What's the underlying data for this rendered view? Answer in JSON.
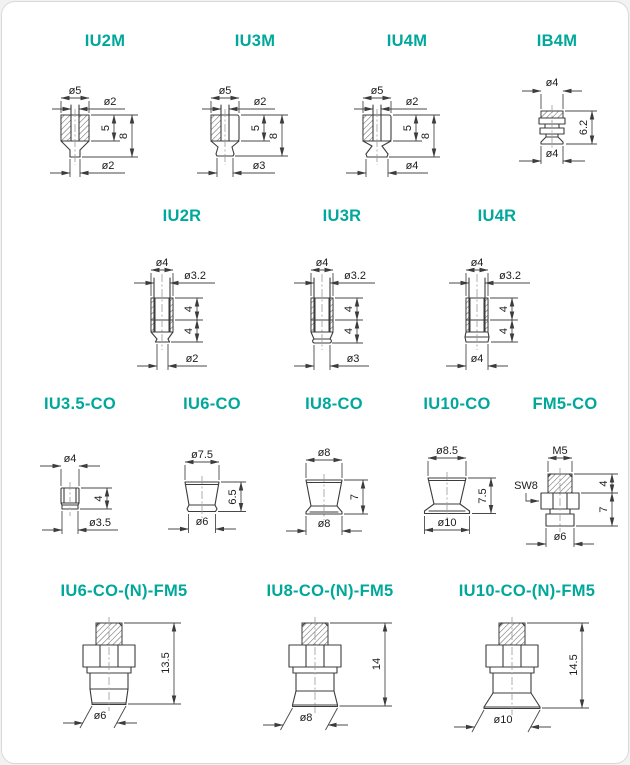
{
  "page": {
    "accent_color": "#00a89b",
    "line_color": "#3c3c3c"
  },
  "figures": {
    "iu2m": {
      "title": "IU2M",
      "top_dia": "ø5",
      "bore_dia": "ø2",
      "height_upper": "5",
      "height_total": "8",
      "bottom_dia": "ø2"
    },
    "iu3m": {
      "title": "IU3M",
      "top_dia": "ø5",
      "bore_dia": "ø2",
      "height_upper": "5",
      "height_total": "8",
      "bottom_dia": "ø3"
    },
    "iu4m": {
      "title": "IU4M",
      "top_dia": "ø5",
      "bore_dia": "ø2",
      "height_upper": "5",
      "height_total": "8",
      "bottom_dia": "ø4"
    },
    "ib4m": {
      "title": "IB4M",
      "top_dia": "ø4",
      "height": "6.2",
      "bottom_dia": "ø4"
    },
    "iu2r": {
      "title": "IU2R",
      "top_dia": "ø4",
      "bore_dia": "ø3.2",
      "height_upper": "4",
      "height_lower": "4",
      "bottom_dia": "ø2"
    },
    "iu3r": {
      "title": "IU3R",
      "top_dia": "ø4",
      "bore_dia": "ø3.2",
      "height_upper": "4",
      "height_lower": "4",
      "bottom_dia": "ø3"
    },
    "iu4r": {
      "title": "IU4R",
      "top_dia": "ø4",
      "bore_dia": "ø3.2",
      "height_upper": "4",
      "height_lower": "4",
      "bottom_dia": "ø4"
    },
    "iu35co": {
      "title": "IU3.5-CO",
      "top_dia": "ø4",
      "height": "4",
      "bottom_dia": "ø3.5"
    },
    "iu6co": {
      "title": "IU6-CO",
      "top_dia": "ø7.5",
      "height": "6.5",
      "bottom_dia": "ø6"
    },
    "iu8co": {
      "title": "IU8-CO",
      "top_dia": "ø8",
      "height": "7",
      "bottom_dia": "ø8"
    },
    "iu10co": {
      "title": "IU10-CO",
      "top_dia": "ø8.5",
      "height": "7.5",
      "bottom_dia": "ø10"
    },
    "fm5co": {
      "title": "FM5-CO",
      "thread": "M5",
      "wrench_flat": "SW8",
      "height_upper": "4",
      "height_lower": "7",
      "bottom_dia": "ø6"
    },
    "iu6fm5": {
      "title": "IU6-CO-(N)-FM5",
      "height": "13.5",
      "bottom_dia": "ø6"
    },
    "iu8fm5": {
      "title": "IU8-CO-(N)-FM5",
      "height": "14",
      "bottom_dia": "ø8"
    },
    "iu10fm5": {
      "title": "IU10-CO-(N)-FM5",
      "height": "14.5",
      "bottom_dia": "ø10"
    }
  }
}
